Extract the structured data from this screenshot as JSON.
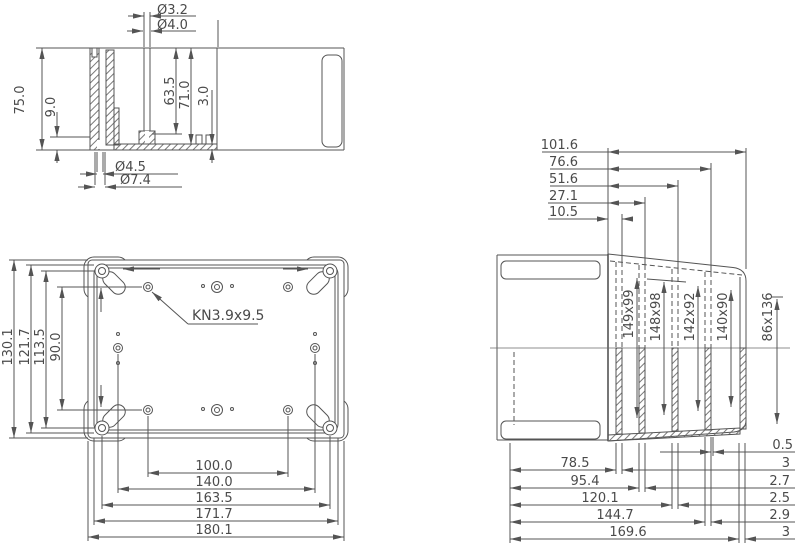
{
  "sheet_title": "Enclosure dimension drawing (three views)",
  "colors": {
    "line": "#545454",
    "text": "#4a4a4a",
    "background": "#ffffff"
  },
  "section_side": {
    "dia_boss_hole": "Ø3.2",
    "dia_boss_bore": "Ø4.0",
    "height_total": "75.0",
    "rim_height": "9.0",
    "boss_height": "63.5",
    "inner_depth": "71.0",
    "floor_thickness": "3.0",
    "dia_screw_hole": "Ø4.5",
    "dia_counterbore": "Ø7.4"
  },
  "plan": {
    "boss_label": "KN3.9x9.5",
    "v": [
      "130.1",
      "121.7",
      "113.5",
      "90.0"
    ],
    "h": [
      "100.0",
      "140.0",
      "163.5",
      "171.7",
      "180.1"
    ]
  },
  "cover": {
    "top": [
      "101.6",
      "76.6",
      "51.6",
      "27.1",
      "10.5"
    ],
    "sections": [
      "149x99",
      "148x98",
      "142x92",
      "140x90",
      "86x136"
    ],
    "bottom": [
      "78.5",
      "95.4",
      "120.1",
      "144.7",
      "169.6"
    ],
    "thickness": [
      "0.5",
      "3",
      "2.7",
      "2.5",
      "2.9",
      "3"
    ]
  }
}
